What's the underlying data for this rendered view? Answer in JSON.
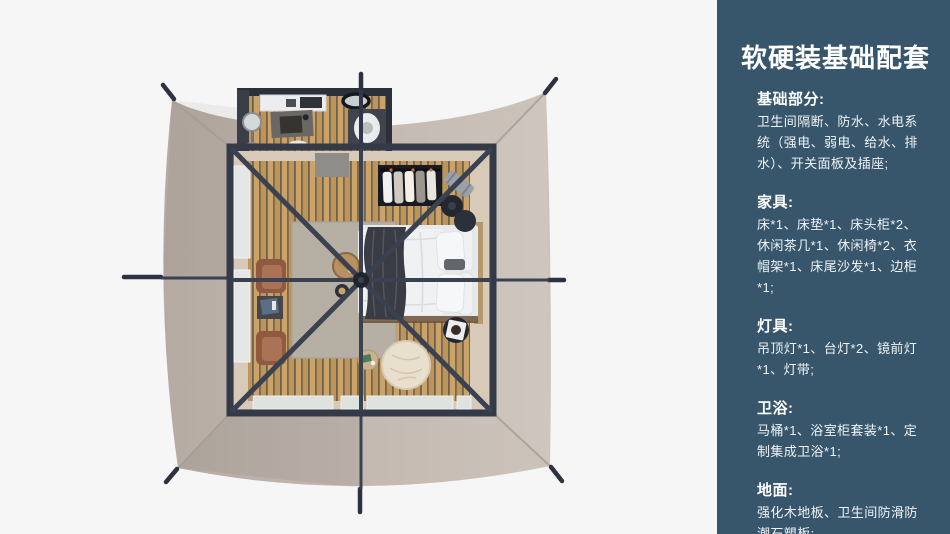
{
  "sidebar": {
    "title": "软硬装基础配套",
    "sections": [
      {
        "heading": "基础部分:",
        "body": "卫生间隔断、防水、水电系统（强电、弱电、给水、排水）、开关面板及插座;"
      },
      {
        "heading": "家具:",
        "body": "床*1、床垫*1、床头柜*2、休闲茶几*1、休闲椅*2、衣帽架*1、床尾沙发*1、边柜*1;"
      },
      {
        "heading": "灯具:",
        "body": "吊顶灯*1、台灯*2、镜前灯*1、灯带;"
      },
      {
        "heading": "卫浴:",
        "body": "马桶*1、浴室柜套装*1、定制集成卫浴*1;"
      },
      {
        "heading": "地面:",
        "body": "强化木地板、卫生间防滑防潮石塑板;"
      }
    ]
  },
  "floorplan": {
    "type": "top-down tent room render",
    "colors": {
      "page_background": "#f6f6f7",
      "sidebar_background": "#37566b",
      "tent_canvas": "#c4bab2",
      "frame": "#343a48",
      "wood_floor": "#c79e62",
      "interior_border": "#d8cab8"
    }
  }
}
